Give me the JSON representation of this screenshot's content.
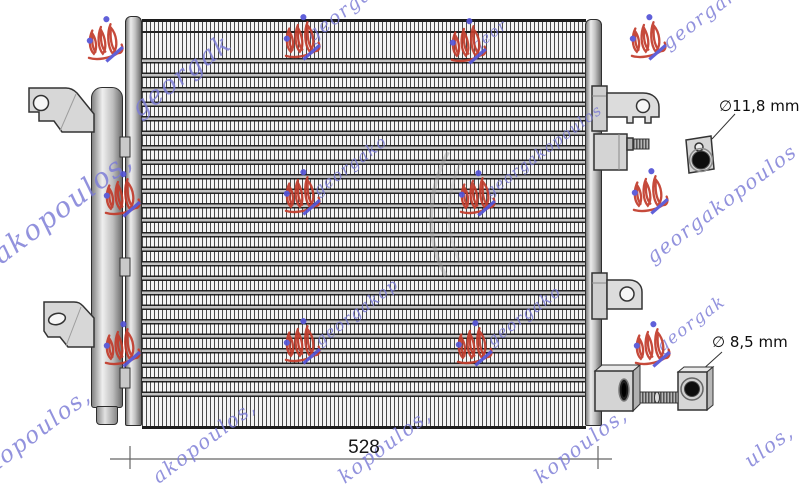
{
  "labels": {
    "width_dimension_mm": "528",
    "top_fitting_diameter": "∅11,8 mm",
    "bottom_fitting_diameter": "∅ 8,5 mm"
  },
  "watermark": {
    "brand": "georgakopoulos",
    "text_color": "#7b7bd6",
    "logo_red": "#c23b2b",
    "logo_blue": "#5353d6",
    "fragments": [
      {
        "text": "georgak",
        "x": 136,
        "y": 96,
        "s": 26
      },
      {
        "text": "gakopoulos,",
        "x": -18,
        "y": 252,
        "s": 28
      },
      {
        "text": "akopoulos,",
        "x": -22,
        "y": 464,
        "s": 23
      },
      {
        "text": "georgako",
        "x": 310,
        "y": 26,
        "s": 19
      },
      {
        "text": "geor",
        "x": 474,
        "y": 38,
        "s": 15
      },
      {
        "text": "georgako",
        "x": 666,
        "y": 34,
        "s": 19
      },
      {
        "text": "georgako",
        "x": 316,
        "y": 182,
        "s": 16
      },
      {
        "text": "georgakopoulos",
        "x": 488,
        "y": 184,
        "s": 15
      },
      {
        "text": "georgakop",
        "x": 318,
        "y": 332,
        "s": 16
      },
      {
        "text": "georgako",
        "x": 490,
        "y": 332,
        "s": 16
      },
      {
        "text": "georgak",
        "x": 660,
        "y": 338,
        "s": 17
      },
      {
        "text": "georgakopoulos",
        "x": 650,
        "y": 246,
        "s": 20
      },
      {
        "text": "kopoulos,",
        "x": 538,
        "y": 466,
        "s": 20
      },
      {
        "text": "akopoulos,",
        "x": 156,
        "y": 466,
        "s": 20
      },
      {
        "text": "kopoulos,",
        "x": 342,
        "y": 466,
        "s": 20
      },
      {
        "text": "ulos,",
        "x": 748,
        "y": 450,
        "s": 20
      }
    ],
    "logos": [
      [
        105,
        40
      ],
      [
        302,
        38
      ],
      [
        468,
        42
      ],
      [
        648,
        38
      ],
      [
        122,
        195
      ],
      [
        302,
        193
      ],
      [
        477,
        194
      ],
      [
        650,
        192
      ],
      [
        122,
        345
      ],
      [
        302,
        342
      ],
      [
        474,
        344
      ],
      [
        652,
        345
      ]
    ]
  }
}
